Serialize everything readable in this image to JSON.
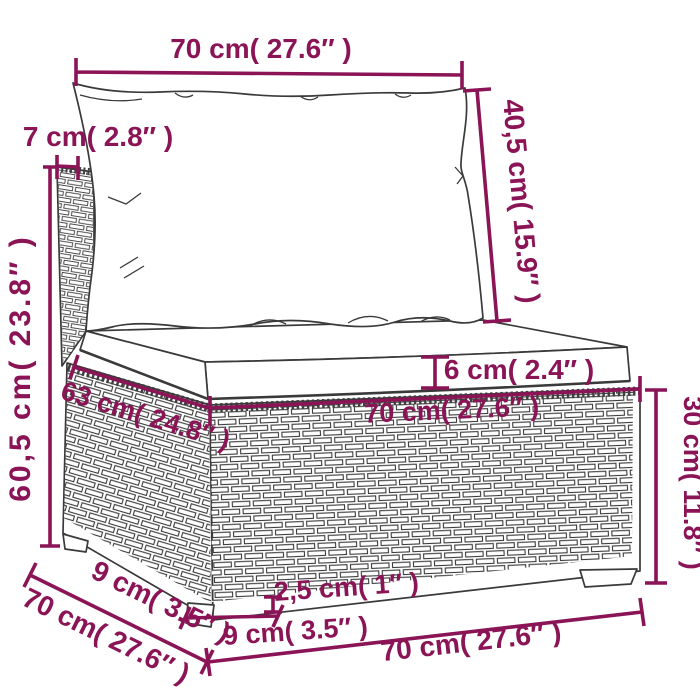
{
  "figure": {
    "alt": "Line drawing of a poly rattan garden sofa middle section with a back cushion and a seat cushion, annotated with dimensions"
  },
  "colors": {
    "dimension": "#8a1456",
    "outline": "#3a3a3a",
    "background": "#ffffff"
  },
  "dims": {
    "top_width": "70 cm( 27.6″ )",
    "back_panel_depth": "7 cm( 2.8″ )",
    "back_cushion_height": "40,5 cm( 15.9″ )",
    "overall_height": "60,5 cm( 23.8″ )",
    "inner_depth": "63 cm( 24.8″ )",
    "seat_cushion_thickness": "6 cm( 2.4″ )",
    "seat_front_width": "70 cm( 27.6″ )",
    "base_height": "30 cm( 11.8″ )",
    "foot_clearance": "2,5 cm( 1″ )",
    "front_foot_width": "9 cm( 3.5″ )",
    "side_foot_depth": "9 cm( 3.5″ )",
    "side_depth": "70 cm( 27.6″ )",
    "front_bottom_width": "70 cm( 27.6″ )"
  }
}
